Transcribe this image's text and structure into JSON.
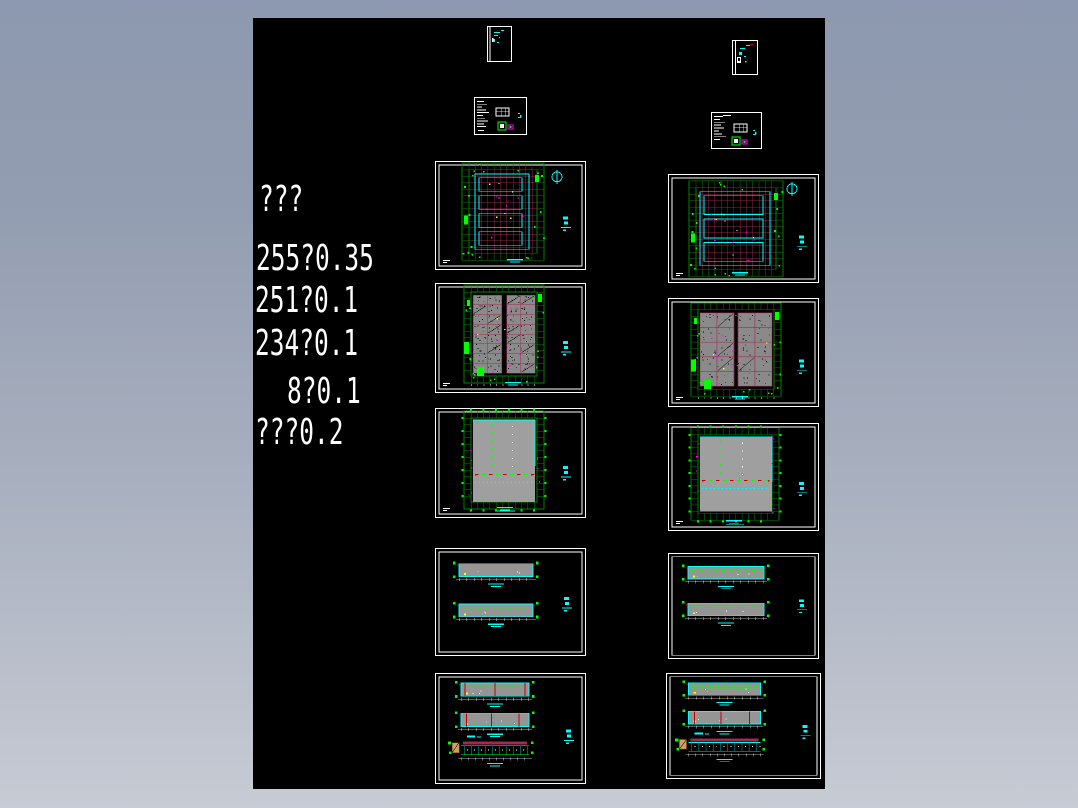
{
  "window": {
    "background_top": "#8d99b0",
    "background_bottom": "#c7cbd4",
    "canvas_color": "#000000"
  },
  "annotations": {
    "color": "#ffffff",
    "lines": [
      "???",
      "255?0.35",
      "251?0.1",
      "234?0.1",
      "8?0.1",
      "???0.2"
    ]
  },
  "palette": {
    "white": "#ffffff",
    "cyan": "#00ffff",
    "bright_green": "#00ff00",
    "dark_green": "#008200",
    "crimson": "#9e2b53",
    "dark_red": "#c00000",
    "magenta": "#ff00ff",
    "yellow": "#ffff00",
    "plan_cell_gray": "#8a8a8a",
    "roof_gray": "#9f9f9f",
    "elevation_gray": "#959595",
    "tan": "#cf9f66",
    "teal": "#00b0b0"
  },
  "thumbnails": {
    "left_column": [
      "cover-sheet",
      "notes-sheet",
      "floor-plan",
      "detail-plan",
      "roof-plan",
      "elevations",
      "elevations-and-section"
    ],
    "right_column": [
      "cover-sheet",
      "notes-sheet",
      "floor-plan",
      "detail-plan",
      "roof-plan",
      "elevations",
      "elevations-and-section"
    ]
  }
}
